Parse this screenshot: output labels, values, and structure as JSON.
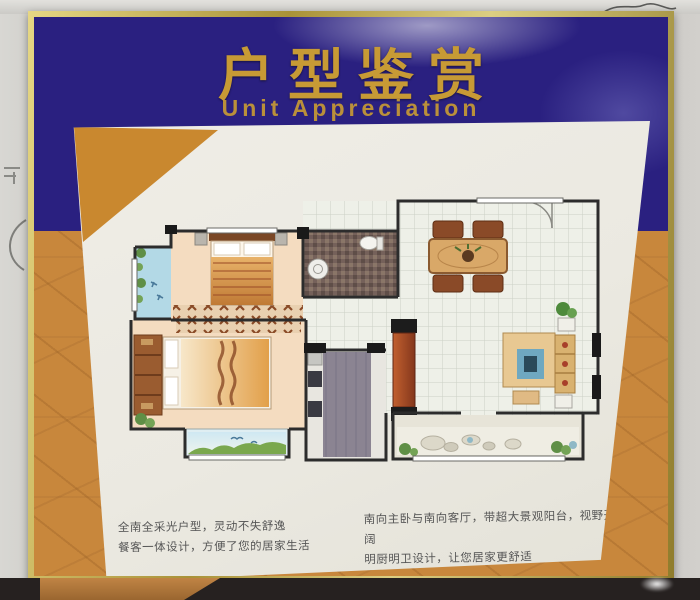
{
  "header": {
    "title": "户型鉴赏",
    "subtitle": "Unit Appreciation"
  },
  "descriptions": {
    "left_line1": "全南全采光户型，灵动不失舒逸",
    "left_line2": "餐客一体设计，方便了您的居家生活",
    "right_line1": "南向主卧与南向客厅，带超大景观阳台，视野开阔",
    "right_line2": "明厨明卫设计，让您居家更舒适"
  },
  "colors": {
    "header_blue": "#2a2080",
    "title_gold": "#c79a35",
    "backing_orange": "#c8873c",
    "triangle_orange": "#c9882f",
    "frame_gold": "#b5a044",
    "poster_cream": "#ebe9e1",
    "text_gray": "#565656",
    "balcony_blue": "#b3d9e6",
    "wood_floor": "#f4dcc0",
    "tile_floor": "#eef0e8",
    "bathroom_dark": "#75615a",
    "kitchen_gray": "#8b8492"
  }
}
